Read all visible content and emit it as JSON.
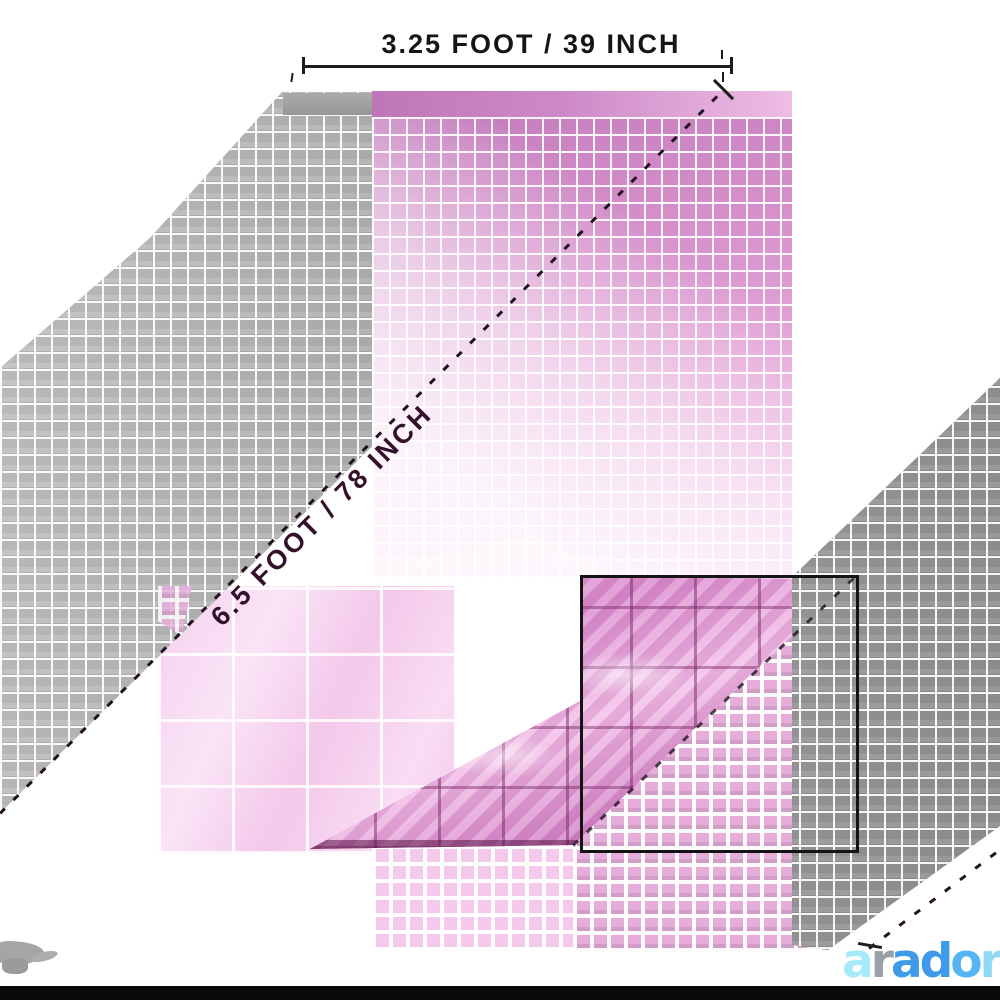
{
  "annotations": {
    "width_label": "3.25 FOOT / 39 INCH",
    "height_label": "6.5 FOOT / 78 INCH"
  },
  "logo": {
    "text": "arador",
    "letters": [
      {
        "ch": "a",
        "color": "#a6e9f8"
      },
      {
        "ch": "r",
        "color": "#98a0a8"
      },
      {
        "ch": "a",
        "color": "#3f9bea"
      },
      {
        "ch": "d",
        "color": "#3f9bea"
      },
      {
        "ch": "o",
        "color": "#55b5f3"
      },
      {
        "ch": "r",
        "color": "#90d9f5"
      }
    ]
  },
  "colors": {
    "gray_curtain": "#a6a6a6",
    "pink_curtain": "#d893cd",
    "pink_header_band": "#c57fbf",
    "pale_foil_inset": "#f8dbf3",
    "shiny_foil_inset": "#e29bd4",
    "dimension_line": "#1c1c1c",
    "inset_frame": "#141414",
    "bottom_bar": "#0a0a0a"
  }
}
